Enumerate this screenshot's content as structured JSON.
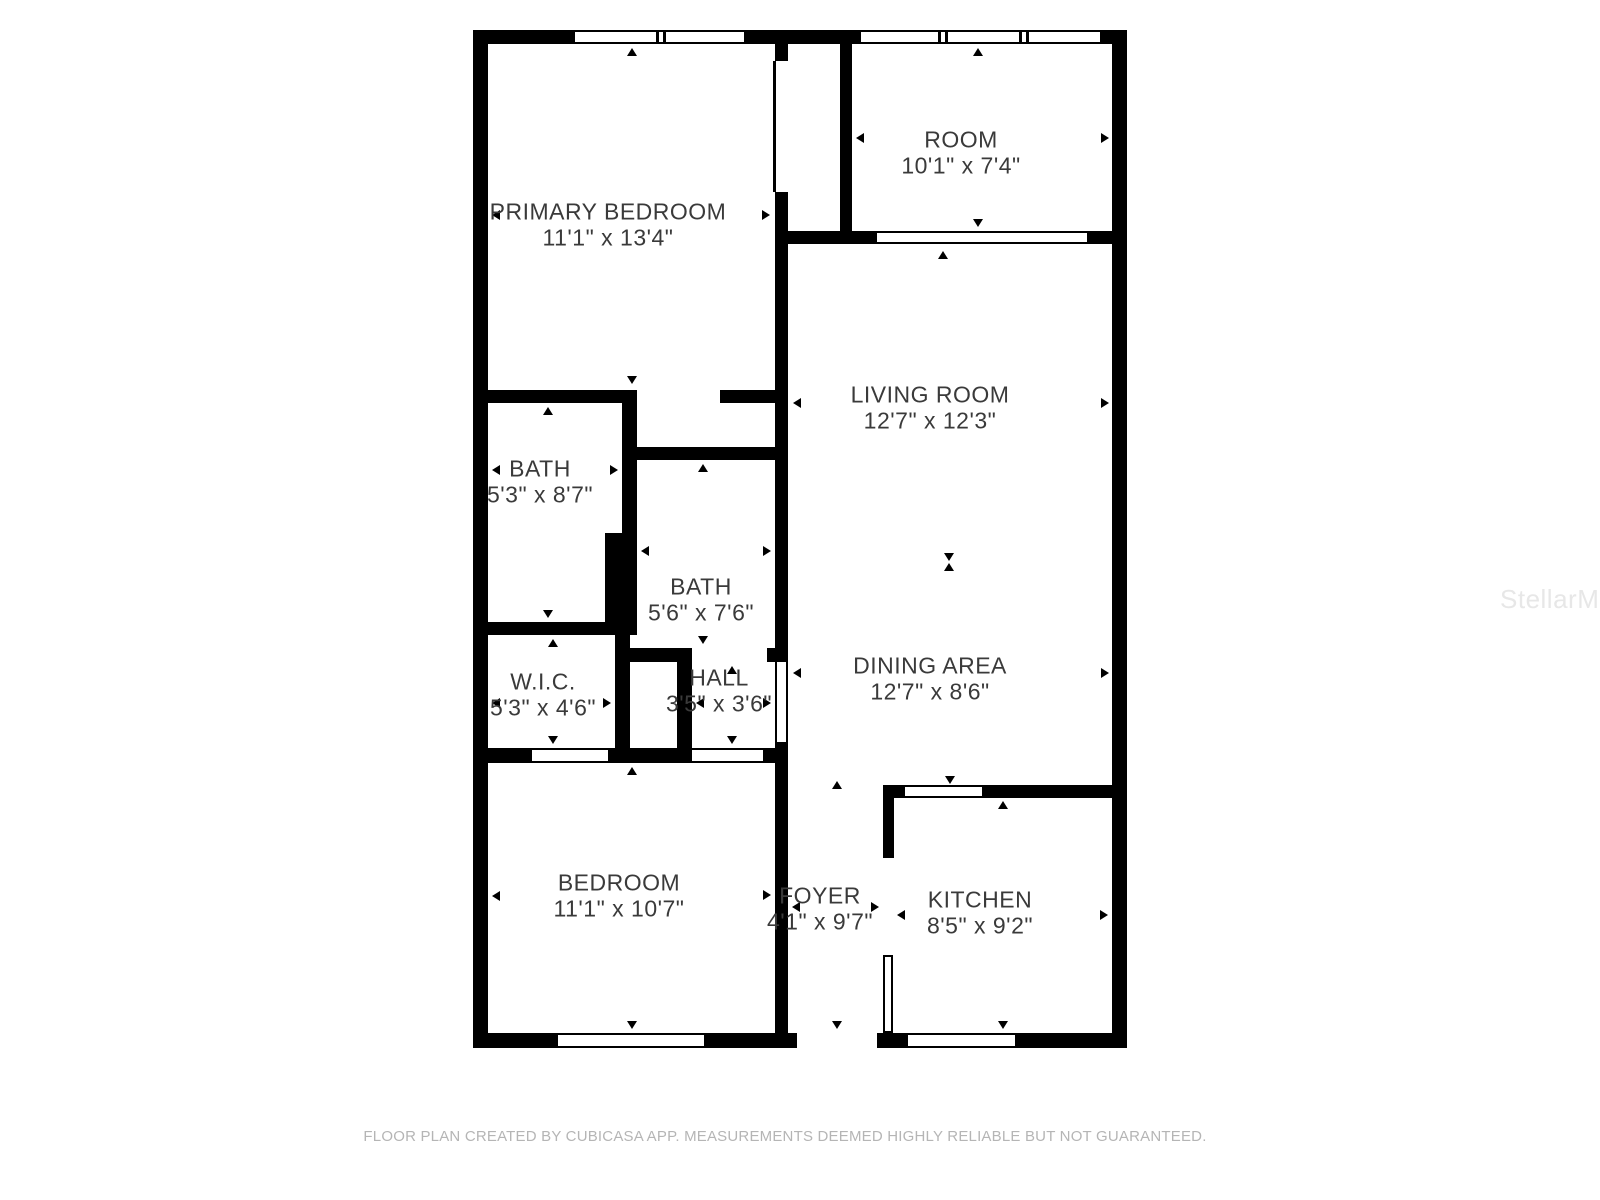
{
  "page": {
    "background": "#ffffff"
  },
  "watermark": {
    "text": "StellarMLS",
    "color": "#e7e7e7"
  },
  "footer": {
    "text": "FLOOR PLAN CREATED BY CUBICASA APP. MEASUREMENTS DEEMED HIGHLY RELIABLE BUT NOT GUARANTEED.",
    "color": "#b5b5b5"
  },
  "floorplan": {
    "wall_color": "#000000",
    "label_color": "#3a3a3a",
    "rooms": [
      {
        "id": "primary-bedroom",
        "name": "PRIMARY BEDROOM",
        "dims": "11'1\" x 13'4\"",
        "label_x": 608,
        "label_y": 212
      },
      {
        "id": "room",
        "name": "ROOM",
        "dims": "10'1\" x 7'4\"",
        "label_x": 961,
        "label_y": 140
      },
      {
        "id": "living-room",
        "name": "LIVING ROOM",
        "dims": "12'7\" x 12'3\"",
        "label_x": 930,
        "label_y": 395
      },
      {
        "id": "bath",
        "name": "BATH",
        "dims": "5'3\" x 8'7\"",
        "label_x": 540,
        "label_y": 469
      },
      {
        "id": "bath-2",
        "name": "BATH",
        "dims": "5'6\" x 7'6\"",
        "label_x": 701,
        "label_y": 587
      },
      {
        "id": "wic",
        "name": "W.I.C.",
        "dims": "5'3\" x 4'6\"",
        "label_x": 543,
        "label_y": 682
      },
      {
        "id": "hall",
        "name": "HALL",
        "dims": "3'5\" x 3'6\"",
        "label_x": 719,
        "label_y": 678
      },
      {
        "id": "dining-area",
        "name": "DINING AREA",
        "dims": "12'7\" x 8'6\"",
        "label_x": 930,
        "label_y": 666
      },
      {
        "id": "bedroom",
        "name": "BEDROOM",
        "dims": "11'1\" x 10'7\"",
        "label_x": 619,
        "label_y": 883
      },
      {
        "id": "foyer",
        "name": "FOYER",
        "dims": "4'1\" x 9'7\"",
        "label_x": 820,
        "label_y": 896
      },
      {
        "id": "kitchen",
        "name": "KITCHEN",
        "dims": "8'5\" x 9'2\"",
        "label_x": 980,
        "label_y": 900
      }
    ],
    "walls": [
      [
        473,
        30,
        654,
        14
      ],
      [
        473,
        1033,
        654,
        15
      ],
      [
        473,
        30,
        15,
        1018
      ],
      [
        1112,
        30,
        15,
        1018
      ],
      [
        775,
        44,
        13,
        17
      ],
      [
        775,
        192,
        13,
        470
      ],
      [
        775,
        742,
        13,
        291
      ],
      [
        840,
        44,
        12,
        187
      ],
      [
        775,
        231,
        337,
        13
      ],
      [
        473,
        390,
        164,
        13
      ],
      [
        720,
        390,
        68,
        13
      ],
      [
        622,
        390,
        15,
        143
      ],
      [
        605,
        533,
        32,
        102
      ],
      [
        628,
        447,
        160,
        13
      ],
      [
        473,
        622,
        164,
        13
      ],
      [
        615,
        635,
        15,
        128
      ],
      [
        630,
        648,
        62,
        14
      ],
      [
        767,
        648,
        21,
        14
      ],
      [
        677,
        662,
        15,
        86
      ],
      [
        473,
        748,
        59,
        15
      ],
      [
        608,
        748,
        84,
        15
      ],
      [
        763,
        748,
        25,
        15
      ],
      [
        883,
        785,
        229,
        13
      ],
      [
        883,
        785,
        11,
        73
      ]
    ],
    "windows": [
      {
        "x": 572,
        "y": 30,
        "w": 175,
        "h": 14,
        "orient": "h",
        "dividers": [
          572,
          656,
          663,
          744
        ]
      },
      {
        "x": 858,
        "y": 30,
        "w": 245,
        "h": 14,
        "orient": "h",
        "dividers": [
          858,
          938,
          945,
          1019,
          1026,
          1100
        ]
      },
      {
        "x": 555,
        "y": 1033,
        "w": 152,
        "h": 15,
        "orient": "h",
        "dividers": [
          555,
          704
        ]
      },
      {
        "x": 905,
        "y": 1033,
        "w": 113,
        "h": 15,
        "orient": "h",
        "dividers": [
          905,
          1015
        ]
      },
      {
        "x": 902,
        "y": 785,
        "w": 83,
        "h": 13,
        "orient": "h",
        "dividers": [
          902,
          982
        ]
      }
    ],
    "openings": [
      {
        "x": 877,
        "y": 231,
        "w": 210,
        "h": 13,
        "orient": "h"
      },
      {
        "x": 775,
        "y": 662,
        "w": 13,
        "h": 80,
        "orient": "v"
      },
      {
        "x": 532,
        "y": 748,
        "w": 76,
        "h": 15,
        "orient": "h"
      },
      {
        "x": 692,
        "y": 748,
        "w": 71,
        "h": 15,
        "orient": "h"
      }
    ],
    "gaps": [
      {
        "x": 797,
        "y": 1033,
        "w": 80,
        "h": 15
      }
    ],
    "doors": [
      {
        "type": "leaf-line",
        "x": 773,
        "y": 61,
        "w": 3,
        "h": 131
      },
      {
        "type": "leaf-outline",
        "x": 883,
        "y": 955,
        "w": 10,
        "h": 78
      }
    ],
    "markers": [
      {
        "x": 632,
        "y": 48,
        "dir": "up"
      },
      {
        "x": 492,
        "y": 215,
        "dir": "left"
      },
      {
        "x": 770,
        "y": 215,
        "dir": "right"
      },
      {
        "x": 632,
        "y": 384,
        "dir": "down"
      },
      {
        "x": 978,
        "y": 48,
        "dir": "up"
      },
      {
        "x": 856,
        "y": 138,
        "dir": "left"
      },
      {
        "x": 1109,
        "y": 138,
        "dir": "right"
      },
      {
        "x": 978,
        "y": 227,
        "dir": "down"
      },
      {
        "x": 943,
        "y": 251,
        "dir": "up"
      },
      {
        "x": 793,
        "y": 403,
        "dir": "left"
      },
      {
        "x": 1109,
        "y": 403,
        "dir": "right"
      },
      {
        "x": 949,
        "y": 561,
        "dir": "down"
      },
      {
        "x": 949,
        "y": 563,
        "dir": "up"
      },
      {
        "x": 793,
        "y": 673,
        "dir": "left"
      },
      {
        "x": 1109,
        "y": 673,
        "dir": "right"
      },
      {
        "x": 548,
        "y": 407,
        "dir": "up"
      },
      {
        "x": 492,
        "y": 470,
        "dir": "left"
      },
      {
        "x": 618,
        "y": 470,
        "dir": "right"
      },
      {
        "x": 548,
        "y": 618,
        "dir": "down"
      },
      {
        "x": 703,
        "y": 464,
        "dir": "up"
      },
      {
        "x": 641,
        "y": 551,
        "dir": "left"
      },
      {
        "x": 771,
        "y": 551,
        "dir": "right"
      },
      {
        "x": 703,
        "y": 644,
        "dir": "down"
      },
      {
        "x": 553,
        "y": 639,
        "dir": "up"
      },
      {
        "x": 492,
        "y": 703,
        "dir": "left"
      },
      {
        "x": 611,
        "y": 703,
        "dir": "right"
      },
      {
        "x": 553,
        "y": 744,
        "dir": "down"
      },
      {
        "x": 732,
        "y": 666,
        "dir": "up"
      },
      {
        "x": 696,
        "y": 703,
        "dir": "left"
      },
      {
        "x": 771,
        "y": 703,
        "dir": "right"
      },
      {
        "x": 732,
        "y": 744,
        "dir": "down"
      },
      {
        "x": 632,
        "y": 767,
        "dir": "up"
      },
      {
        "x": 492,
        "y": 896,
        "dir": "left"
      },
      {
        "x": 771,
        "y": 895,
        "dir": "right"
      },
      {
        "x": 632,
        "y": 1029,
        "dir": "down"
      },
      {
        "x": 950,
        "y": 784,
        "dir": "down"
      },
      {
        "x": 837,
        "y": 781,
        "dir": "up"
      },
      {
        "x": 792,
        "y": 907,
        "dir": "left"
      },
      {
        "x": 879,
        "y": 907,
        "dir": "right"
      },
      {
        "x": 837,
        "y": 1029,
        "dir": "down"
      },
      {
        "x": 1003,
        "y": 801,
        "dir": "up"
      },
      {
        "x": 897,
        "y": 915,
        "dir": "left"
      },
      {
        "x": 1108,
        "y": 915,
        "dir": "right"
      },
      {
        "x": 1003,
        "y": 1029,
        "dir": "down"
      }
    ]
  }
}
